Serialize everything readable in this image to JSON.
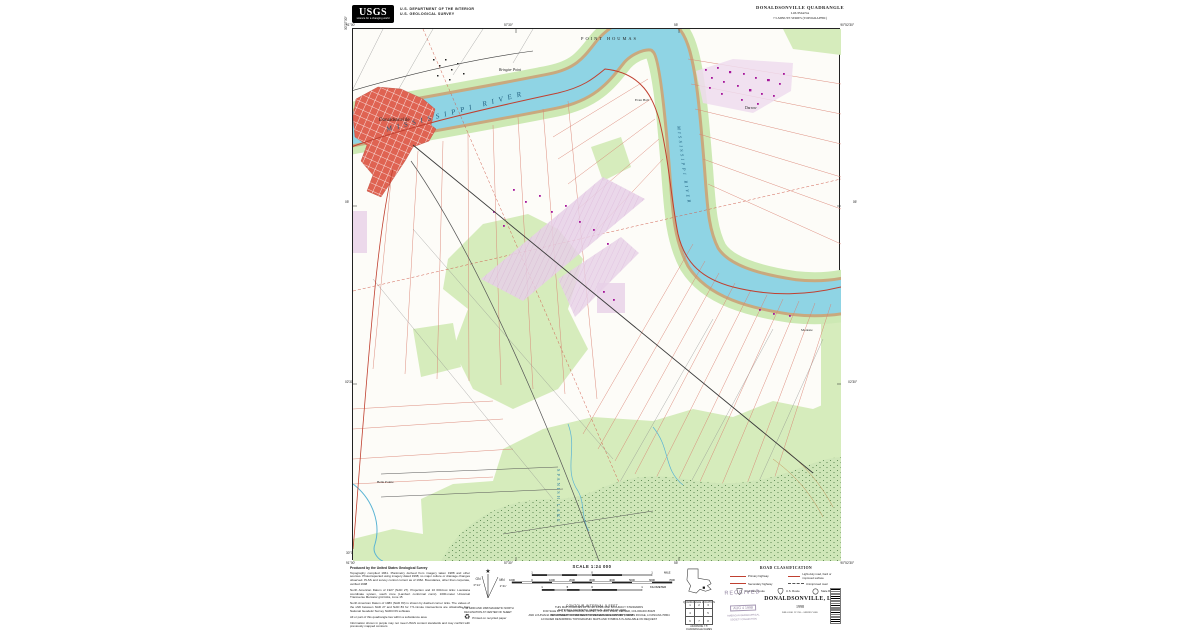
{
  "header": {
    "logo_acronym": "USGS",
    "logo_tagline": "science for a changing world",
    "dept_line1": "U.S. DEPARTMENT OF THE INTERIOR",
    "dept_line2": "U.S. GEOLOGICAL SURVEY",
    "quad_title": "DONALDSONVILLE QUADRANGLE",
    "quad_state": "LOUISIANA",
    "quad_series": "7.5-MINUTE SERIES (TOPOGRAPHIC)"
  },
  "map": {
    "labels": {
      "river": "MISSISSIPPI  RIVER",
      "river_vertical": "MISSISSIPPI RIVER",
      "point_houmas": "POINT  HOUMAS",
      "bringier_point": "Bringier Point",
      "donaldsonville": "Donaldsonville",
      "darrow": "Darrow",
      "evan_hall": "Evan Hall",
      "modeste": "Modeste",
      "belle_pointe": "Belle Pointe",
      "spanish_lake": "SPANISH LAKE"
    },
    "collar": {
      "tl_lon": "91°00′",
      "tl_lat": "30°07′30″",
      "tr_lon": "90°52′30″",
      "tr_lat": "30°07′30″",
      "bl_lon": "91°00′",
      "bl_lat": "30°00′",
      "br_lon": "90°52′30″",
      "br_lat": "30°00′",
      "top_t1": "57′30″",
      "top_t2": "55′",
      "left_t1": "05′",
      "left_t2": "02′30″",
      "bottom_t1": "57′30″",
      "bottom_t2": "55′",
      "right_t1": "05′",
      "right_t2": "02′30″"
    },
    "colors": {
      "water": "#8fd4e4",
      "bank": "#c9a97e",
      "vegetation": "#d6ecbc",
      "swamp_dot": "#4f7d46",
      "urban_red": "#df6352",
      "purple_tint": "#e7d0e7",
      "building_magenta": "#a6179b",
      "lot_line_red": "#d98070",
      "road_black": "#3a3a3a"
    }
  },
  "footer": {
    "credit_heading": "Produced by the United States Geological Survey",
    "credit_p1": "Topography compiled 1961. Planimetry derived from imagery taken 1988 and other sources. Photoinspected using imagery dated 1998; no major culture or drainage changes observed. PLSS and survey control current as of 1962. Boundaries, other than corporate, verified 1998",
    "credit_p2": "North American Datum of 1927 (NAD 27). Projection and 10 000-foot ticks: Louisiana coordinate system, south zone (Lambert conformal conic). 1000-meter Universal Transverse Mercator grid ticks, zone 15",
    "credit_p3": "North American Datum of 1983 (NAD 83) is shown by dashed corner ticks. The values of the shift between NAD 27 and NAD 83 for 7.5-minute intersections are obtainable from National Geodetic Survey NADCON software",
    "credit_p4": "All or part of this quadrangle lies within a subsidence area",
    "credit_p5": "Information shown in purple may not meet USGS content standards and may conflict with previously mapped contours",
    "declination": {
      "gn_label": "GN",
      "mn_label": "MN",
      "gn_value": "0°14′",
      "mn_value": "1°41′",
      "note_line1": "UTM GRID AND 1998 MAGNETIC NORTH",
      "note_line2": "DECLINATION AT CENTER OF SHEET"
    },
    "recycle_note": "Printed on recycled paper",
    "scale": {
      "title": "SCALE 1:24 000",
      "mile_t1": "1",
      "mile_t2": "0",
      "mile_t3": "1",
      "mile_unit": "MILE",
      "feet_t1": "1000",
      "feet_t2": "0",
      "feet_t3": "1000",
      "feet_t4": "2000",
      "feet_t5": "3000",
      "feet_t6": "4000",
      "feet_t7": "5000",
      "feet_t8": "6000",
      "feet_t9": "7000",
      "feet_unit": "FEET",
      "km_t1": "1",
      "km_t2": ".5",
      "km_t3": "0",
      "km_t4": "1",
      "km_unit": "KILOMETER"
    },
    "contour_line1": "CONTOUR INTERVAL 5 FEET",
    "contour_line2": "NATIONAL GEODETIC VERTICAL DATUM OF 1929",
    "contour_line3": "TO CONVERT FROM FEET TO METERS MULTIPLY BY 0.3048",
    "accuracy_line": "THIS MAP COMPLIES WITH NATIONAL MAP ACCURACY STANDARDS",
    "sale_line1": "FOR SALE BY U.S. GEOLOGICAL SURVEY, P.O. BOX 25286, DENVER, COLORADO 80225",
    "sale_line2": "AND LOUISIANA DEPARTMENT OF TRANSPORTATION AND DEVELOPMENT, BATON ROUGE, LOUISIANA 70804",
    "sale_line3": "A FOLDER DESCRIBING TOPOGRAPHIC MAPS AND SYMBOLS IS AVAILABLE ON REQUEST",
    "location_caption": "QUADRANGLE LOCATION",
    "adjoining": {
      "caption": "ADJOINING 7.5′ QUADRANGLE NAMES",
      "n1": "1",
      "n2": "2",
      "n3": "3",
      "n4": "4",
      "n5": "5",
      "n6": "6",
      "n7": "7",
      "n8": "8"
    },
    "road_class": {
      "title": "ROAD CLASSIFICATION",
      "primary": "Primary highway",
      "light_duty": "Light-duty road, hard or improved surface",
      "secondary": "Secondary highway",
      "unimproved": "Unimproved road",
      "interstate": "Interstate Route",
      "us": "U.S. Route",
      "state": "State Route"
    },
    "stamp": {
      "line1": "RECEIVED",
      "line2": "AUG 4 1998",
      "line3": "AMERICAN GEOGRAPHICAL",
      "line4": "SOCIETY COLLECTION"
    },
    "title_block": {
      "name": "DONALDSONVILLE, LA",
      "year": "1998",
      "code": "DMA 8361 IV SW—SERIES V885"
    }
  }
}
